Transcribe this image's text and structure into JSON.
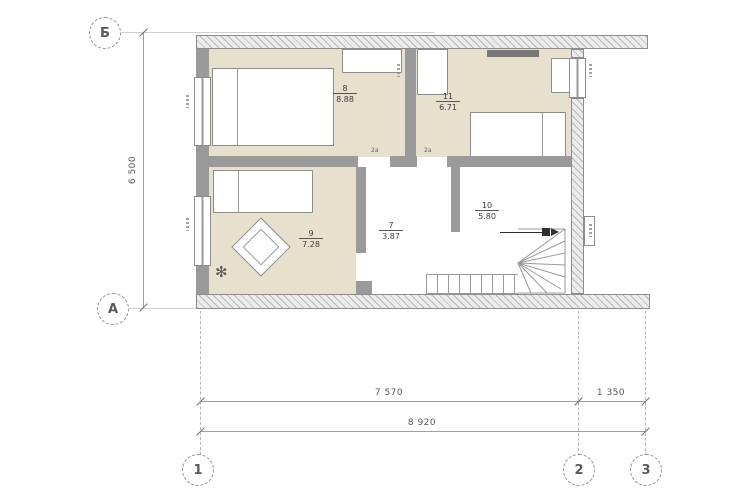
{
  "grid": {
    "row_markers": [
      {
        "label": "Б"
      },
      {
        "label": "А"
      }
    ],
    "column_markers": [
      {
        "label": "1"
      },
      {
        "label": "2"
      },
      {
        "label": "3"
      }
    ]
  },
  "dimensions": {
    "left_vertical": "6 500",
    "bottom_segment_1": "7 570",
    "bottom_segment_2": "1 350",
    "bottom_total": "8 920"
  },
  "rooms": [
    {
      "number": "8",
      "area": "8.88"
    },
    {
      "number": "11",
      "area": "6.71"
    },
    {
      "number": "9",
      "area": "7.28"
    },
    {
      "number": "7",
      "area": "3.87"
    },
    {
      "number": "10",
      "area": "5.80"
    }
  ],
  "door_labels": [
    "2а",
    "2а"
  ],
  "colors": {
    "room_fill": "#e7e0cc",
    "wall": "#9a9a9a",
    "hatch_background": "#ececec",
    "dimension_text": "#555555",
    "background": "#ffffff"
  }
}
